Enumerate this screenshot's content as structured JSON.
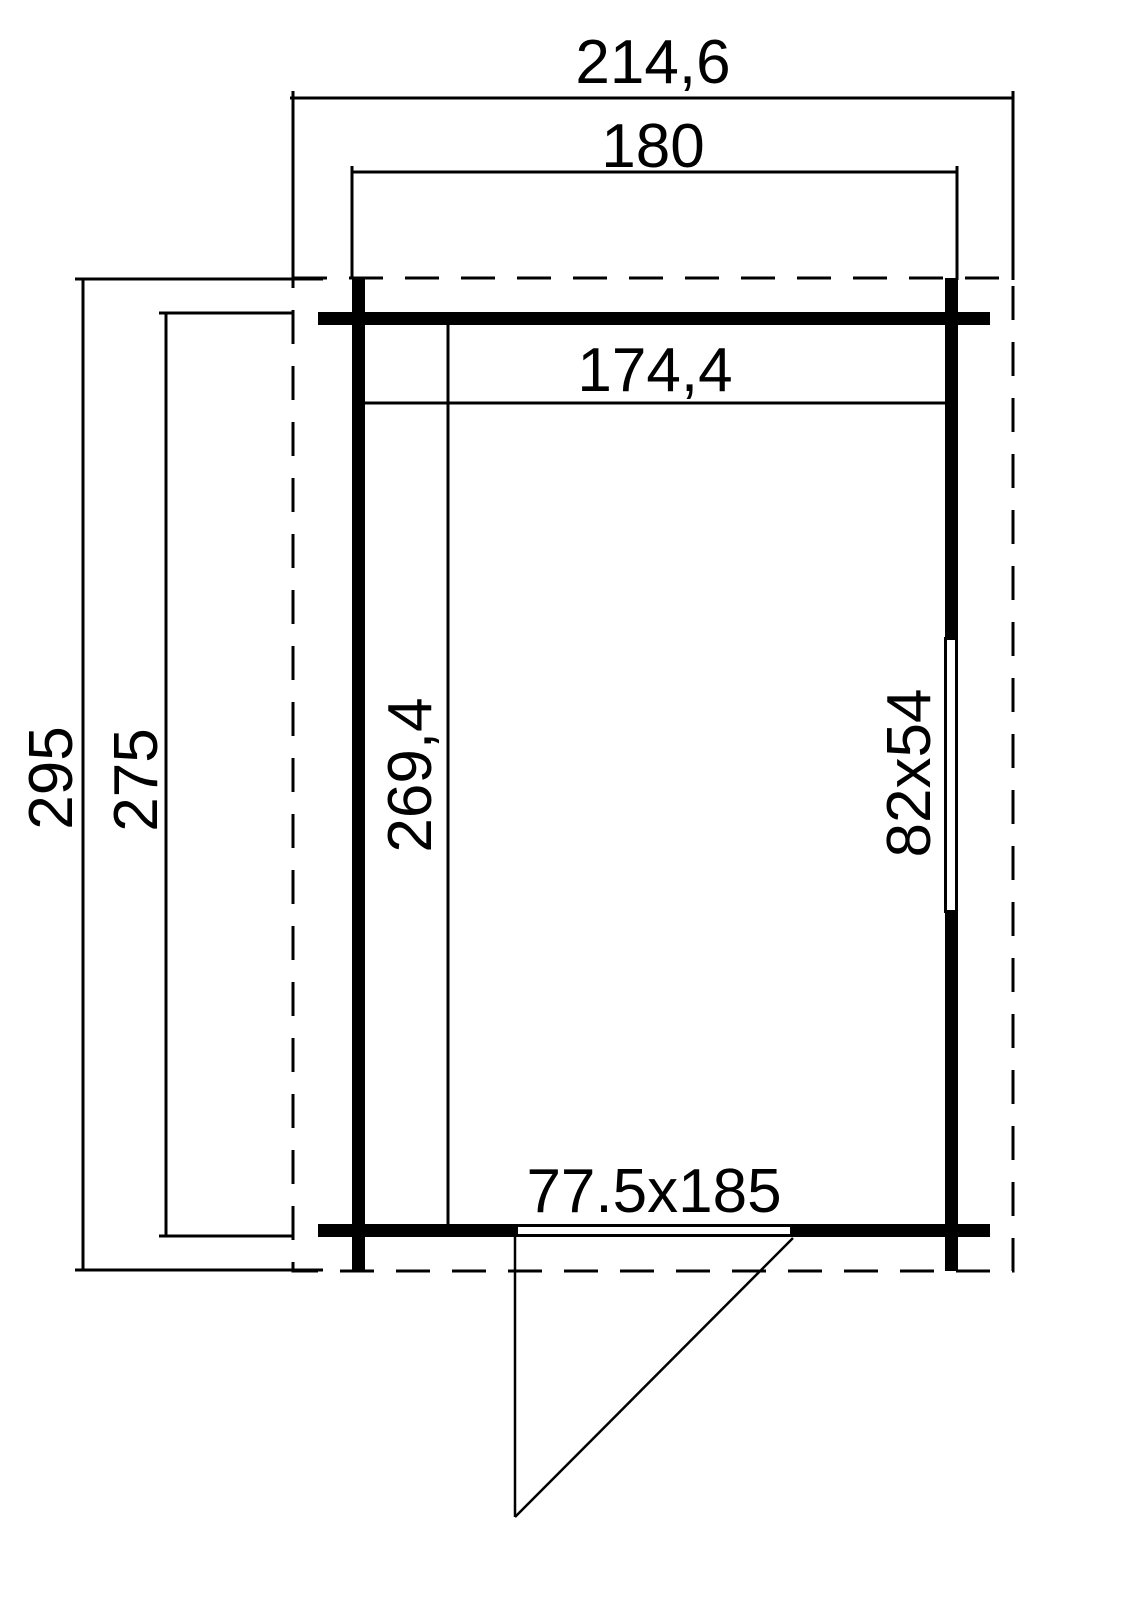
{
  "page": {
    "background": "#ffffff",
    "line_color": "#000000"
  },
  "floor_plan": {
    "type": "shed-floor-plan-with-dimensions",
    "labels": {
      "roof_width": "214,6",
      "outer_width": "180",
      "inner_width": "174,4",
      "roof_depth": "295",
      "outer_depth": "275",
      "inner_depth": "269,4",
      "window_size": "82x54",
      "door_size": "77.5x185"
    }
  }
}
